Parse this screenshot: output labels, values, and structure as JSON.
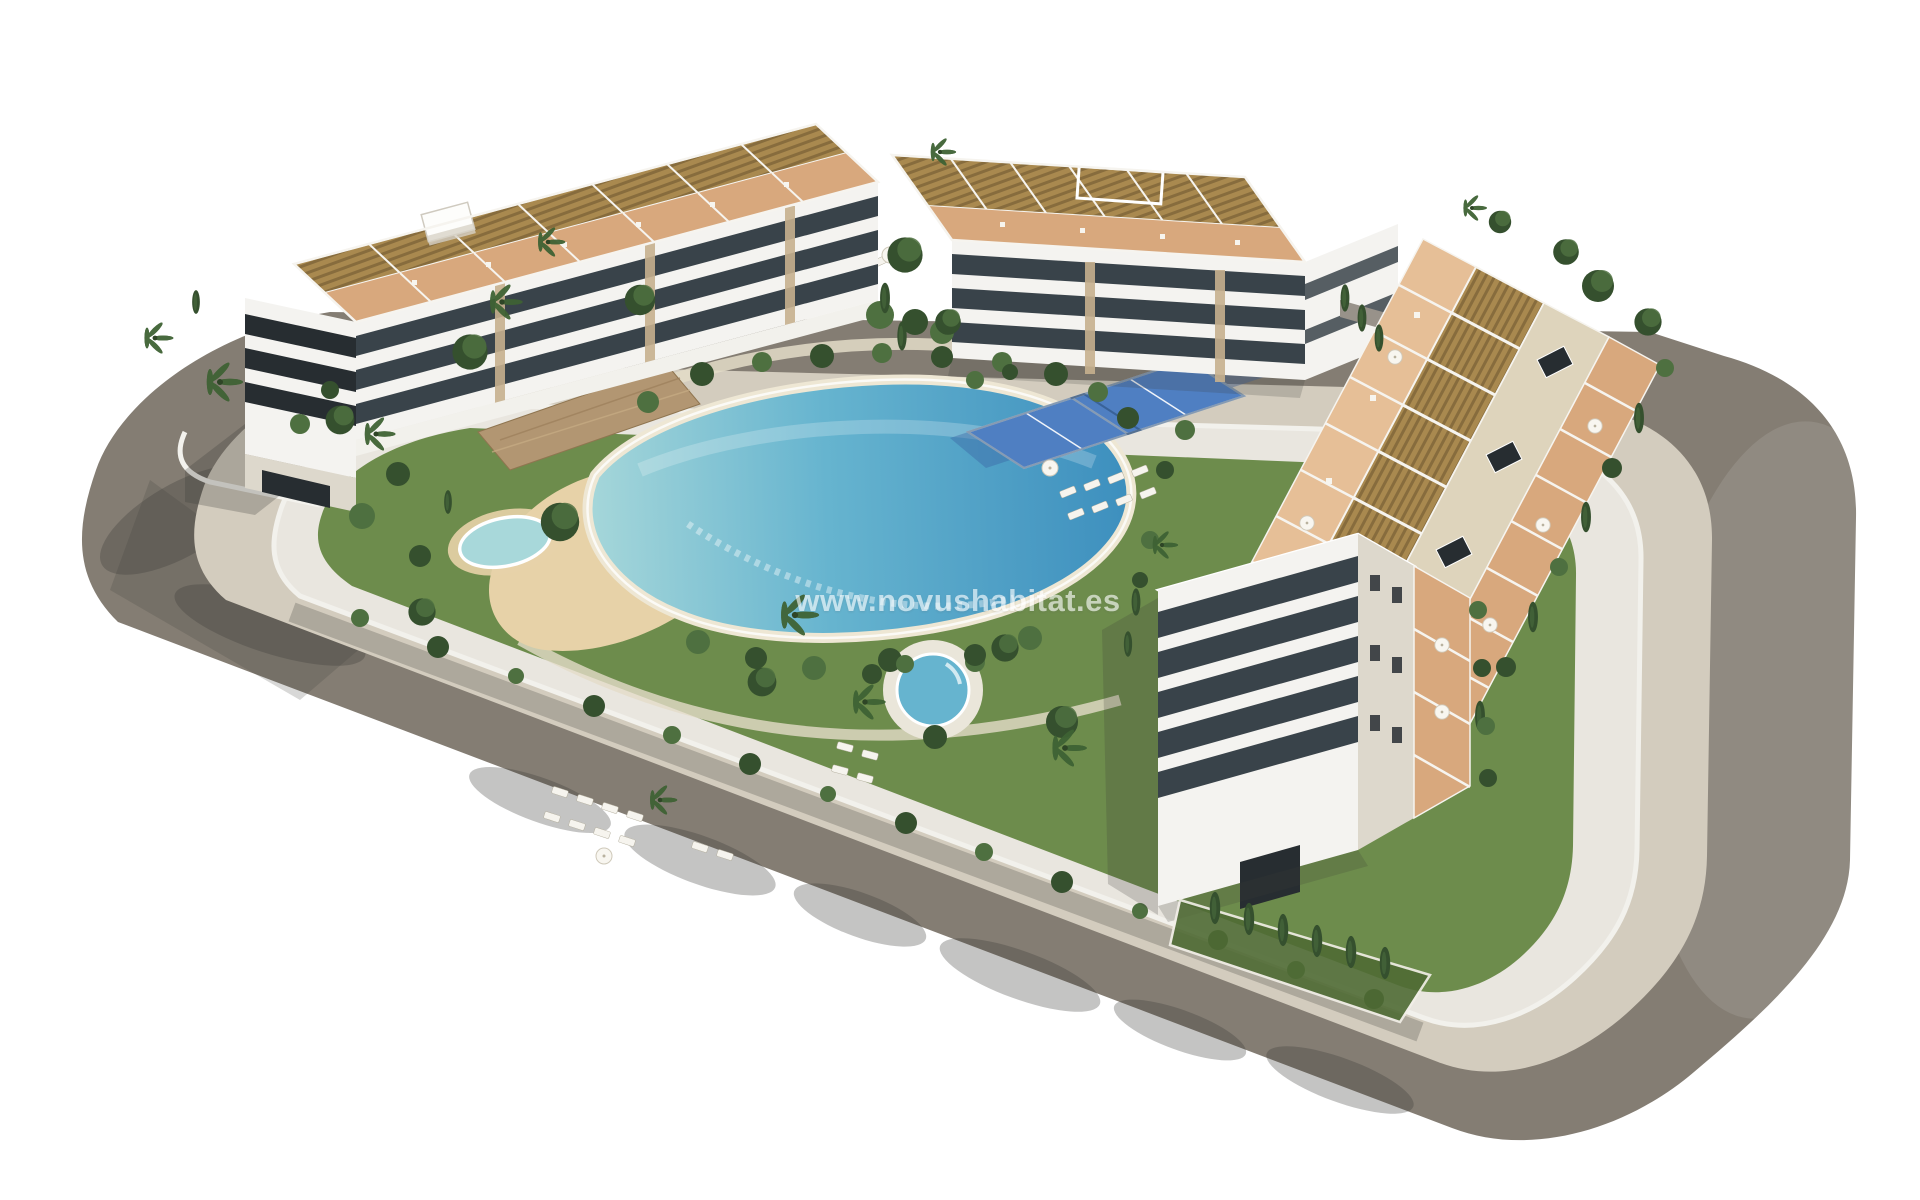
{
  "scene": {
    "description": "Aerial 3D architectural render of a white Mediterranean apartment complex: three apartment blocks with wooden roof pergolas and terracotta roof terraces arranged around a communal garden with a lagoon-style pool with beach entry, a round spa pool, a small kids pool, padel courts, lawns with sun loungers and palm trees, all enclosed by a curving perimeter road with a beige sidewalk, on a plain white background."
  },
  "watermark": {
    "text": "www.novushabitat.es"
  },
  "colors": {
    "background": "#ffffff",
    "asphalt": "#847d73",
    "asphalt_dark": "#6b645c",
    "sidewalk": "#d3ccbe",
    "plot_base": "#e9e6df",
    "plot_wall": "#f2f1ec",
    "facade_white": "#f4f3f0",
    "facade_shade": "#ddd8cc",
    "glazing_dark": "#272d31",
    "glazing_blue": "#39434a",
    "pergola": "#a9894f",
    "pergola_slat": "#7c6236",
    "roof_deck": "#ded4bc",
    "terrace": "#d8a87d",
    "terrace_light": "#e6bf97",
    "lawn": "#6d8c4c",
    "lawn_dark": "#4f6b35",
    "tree_dark": "#35502e",
    "tree_mid": "#4e7040",
    "palm": "#3f6234",
    "pool_deep": "#3d8fbe",
    "pool_mid": "#66b4cf",
    "pool_shallow": "#a8d8da",
    "pool_beach": "#e7d2a8",
    "stone_wall": "#b29672",
    "court_blue": "#4f7fc2",
    "court_blue_dark": "#3a62a3",
    "lounger": "#f6f4ee",
    "shadow": "#3a3a38",
    "watermark": "#ffffff"
  }
}
